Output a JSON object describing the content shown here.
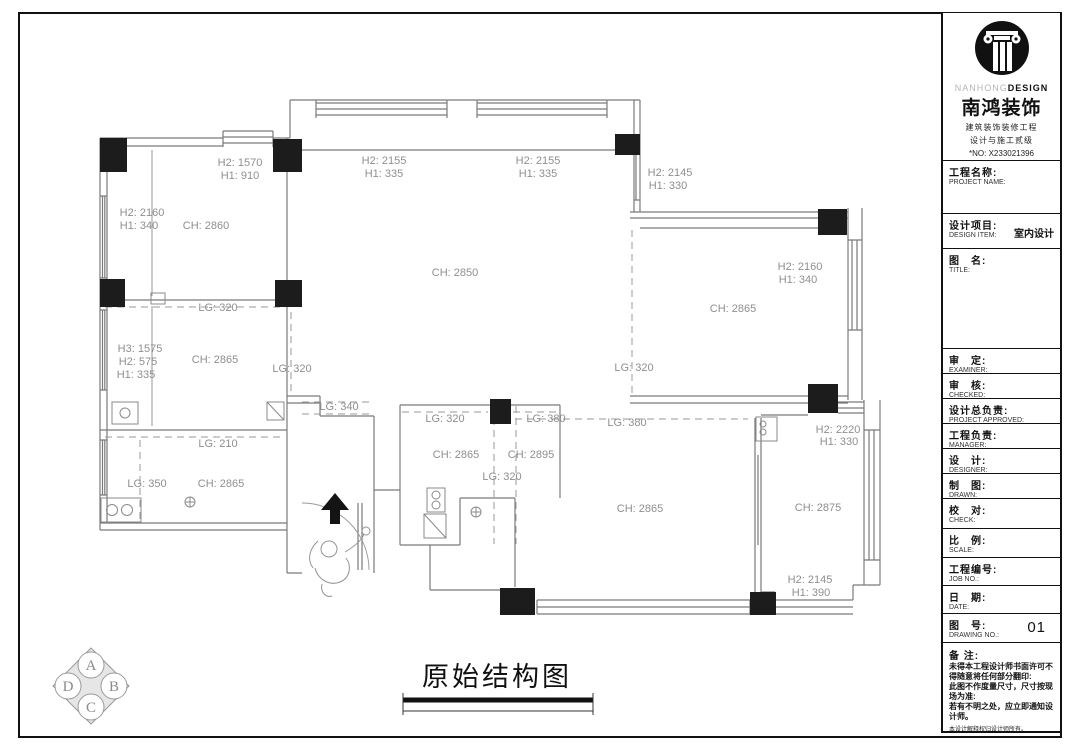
{
  "drawing": {
    "title": "原始结构图",
    "compass": {
      "top": "A",
      "left": "D",
      "bottom": "C",
      "right": "B"
    },
    "labels": [
      {
        "t": "H2: 1570",
        "x": 240,
        "y": 166
      },
      {
        "t": "H1: 910",
        "x": 240,
        "y": 179
      },
      {
        "t": "H2: 2160",
        "x": 142,
        "y": 216
      },
      {
        "t": "H1: 340",
        "x": 139,
        "y": 229
      },
      {
        "t": "CH: 2860",
        "x": 206,
        "y": 229
      },
      {
        "t": "H2: 2155",
        "x": 384,
        "y": 164
      },
      {
        "t": "H1: 335",
        "x": 384,
        "y": 177
      },
      {
        "t": "H2: 2155",
        "x": 538,
        "y": 164
      },
      {
        "t": "H1: 335",
        "x": 538,
        "y": 177
      },
      {
        "t": "CH: 2850",
        "x": 455,
        "y": 276
      },
      {
        "t": "H2: 2145",
        "x": 670,
        "y": 176
      },
      {
        "t": "H1: 330",
        "x": 668,
        "y": 189
      },
      {
        "t": "H2: 2160",
        "x": 800,
        "y": 270
      },
      {
        "t": "H1: 340",
        "x": 798,
        "y": 283
      },
      {
        "t": "CH: 2865",
        "x": 733,
        "y": 312
      },
      {
        "t": "LG: 320",
        "x": 218,
        "y": 311
      },
      {
        "t": "H3: 1575",
        "x": 140,
        "y": 352
      },
      {
        "t": "H2: 575",
        "x": 138,
        "y": 365
      },
      {
        "t": "H1: 335",
        "x": 136,
        "y": 378
      },
      {
        "t": "CH: 2865",
        "x": 215,
        "y": 363
      },
      {
        "t": "LG: 320",
        "x": 292,
        "y": 372
      },
      {
        "t": "LG: 320",
        "x": 634,
        "y": 371
      },
      {
        "t": "LG: 210",
        "x": 218,
        "y": 447
      },
      {
        "t": "LG: 350",
        "x": 147,
        "y": 487
      },
      {
        "t": "CH: 2865",
        "x": 221,
        "y": 487
      },
      {
        "t": "LG: 340",
        "x": 339,
        "y": 410
      },
      {
        "t": "LG: 320",
        "x": 445,
        "y": 422
      },
      {
        "t": "LG: 380",
        "x": 546,
        "y": 422
      },
      {
        "t": "CH: 2865",
        "x": 456,
        "y": 458
      },
      {
        "t": "CH: 2895",
        "x": 531,
        "y": 458
      },
      {
        "t": "LG: 320",
        "x": 502,
        "y": 480
      },
      {
        "t": "LG: 380",
        "x": 627,
        "y": 426
      },
      {
        "t": "CH: 2865",
        "x": 640,
        "y": 512
      },
      {
        "t": "H2: 2220",
        "x": 838,
        "y": 433
      },
      {
        "t": "H1: 330",
        "x": 839,
        "y": 445
      },
      {
        "t": "CH: 2875",
        "x": 818,
        "y": 511
      },
      {
        "t": "H2: 2145",
        "x": 810,
        "y": 583
      },
      {
        "t": "H1: 390",
        "x": 811,
        "y": 596
      }
    ]
  },
  "titleblock": {
    "brand": {
      "en_light": "NANHONG",
      "en_bold": "DESIGN",
      "cn": "南鸿装饰",
      "line1": "建筑装饰装修工程",
      "line2": "设计与施工贰级",
      "no": "*NO: X233021396"
    },
    "fields": [
      {
        "cn": "工程名称:",
        "en": "PROJECT NAME:",
        "value": ""
      },
      {
        "cn": "设计项目:",
        "en": "DESIGN ITEM:",
        "value": "室内设计"
      },
      {
        "cn": "图　名:",
        "en": "TITLE:",
        "value": ""
      },
      {
        "cn": "审　定:",
        "en": "EXAMINER:",
        "value": ""
      },
      {
        "cn": "审　核:",
        "en": "CHECKED:",
        "value": ""
      },
      {
        "cn": "设计总负责:",
        "en": "PROJECT APPROVED:",
        "value": ""
      },
      {
        "cn": "工程负责:",
        "en": "MANAGER:",
        "value": ""
      },
      {
        "cn": "设　计:",
        "en": "DESIGNER:",
        "value": ""
      },
      {
        "cn": "制　图:",
        "en": "DRAWN:",
        "value": ""
      },
      {
        "cn": "校　对:",
        "en": "CHECK:",
        "value": ""
      },
      {
        "cn": "比　例:",
        "en": "SCALE:",
        "value": ""
      },
      {
        "cn": "工程编号:",
        "en": "JOB NO.:",
        "value": ""
      },
      {
        "cn": "日　期:",
        "en": "DATE:",
        "value": ""
      },
      {
        "cn": "图　号:",
        "en": "DRAWING NO.:",
        "value": "01"
      }
    ],
    "notes": {
      "label": "备 注:",
      "lines": [
        "未得本工程设计师书面许可不得随意将任何部分翻印:",
        "此图不作度量尺寸，尺寸按现场为准:",
        "若有不明之处，应立即通知设计师。"
      ],
      "fine": "本设计解释权归设计师所有。",
      "hotline": "免费质询电话:400 8383 168"
    }
  }
}
